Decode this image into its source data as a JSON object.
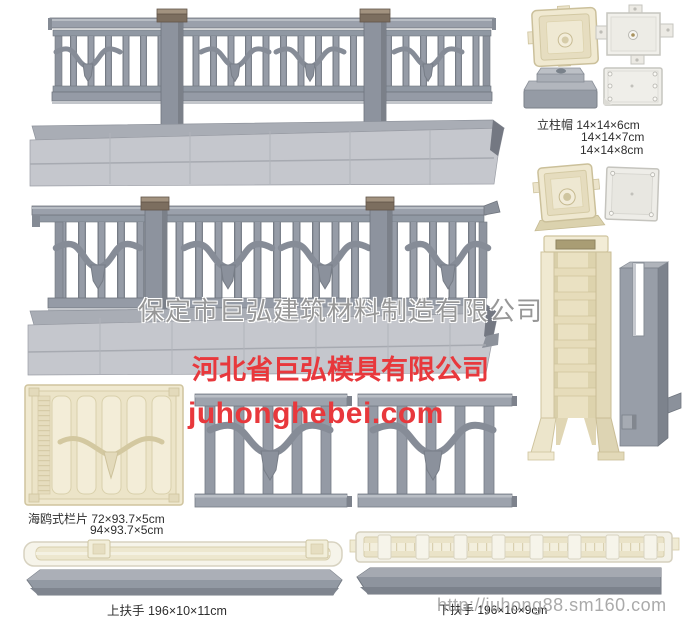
{
  "canvas": {
    "width": 689,
    "height": 620,
    "background": "#ffffff"
  },
  "colors": {
    "accent_red": "#e8383c",
    "watermark_gray": "#979797",
    "rail_gray": "#959ba6",
    "beam_gray": "#c5c7cd",
    "post_cap_brown": "#7e7061",
    "mold_cream": "#f1ebd3",
    "plate_white": "#f0efeb",
    "label_text": "#2e2e2e"
  },
  "watermarks": {
    "company": "保定市巨弘建筑材料制造有限公司",
    "url": "http://juhong88.sm160.com"
  },
  "branding": {
    "company": "河北省巨弘模具有限公司",
    "website": "juhonghebei.com"
  },
  "labels": {
    "post_cap_line1": "立柱帽 14×14×6cm",
    "post_cap_line2": "14×14×7cm",
    "post_cap_line3": "14×14×8cm",
    "seagull_panel_line1": "海鸥式栏片 72×93.7×5cm",
    "seagull_panel_line2": "94×93.7×5cm",
    "top_handrail": "上扶手 196×10×11cm",
    "bottom_handrail": "下扶手 196×10×9cm"
  },
  "figures": [
    {
      "name": "seagull-railing-small"
    },
    {
      "name": "base-beam-1"
    },
    {
      "name": "seagull-railing-large"
    },
    {
      "name": "base-beam-2"
    },
    {
      "name": "seagull-panel-mold-cream"
    },
    {
      "name": "seagull-panel-casting-left"
    },
    {
      "name": "seagull-panel-casting-right"
    },
    {
      "name": "post-cap-mold-top-view"
    },
    {
      "name": "post-cap-cross-plate"
    },
    {
      "name": "post-cap-casting-gray"
    },
    {
      "name": "post-cap-base-plate"
    },
    {
      "name": "post-base-mold-angled"
    },
    {
      "name": "post-base-plate-small"
    },
    {
      "name": "column-mold-tall-cream"
    },
    {
      "name": "slotted-column-casting-gray"
    },
    {
      "name": "top-handrail-mold"
    },
    {
      "name": "top-handrail-casting"
    },
    {
      "name": "bottom-handrail-mold"
    },
    {
      "name": "bottom-handrail-casting"
    }
  ]
}
